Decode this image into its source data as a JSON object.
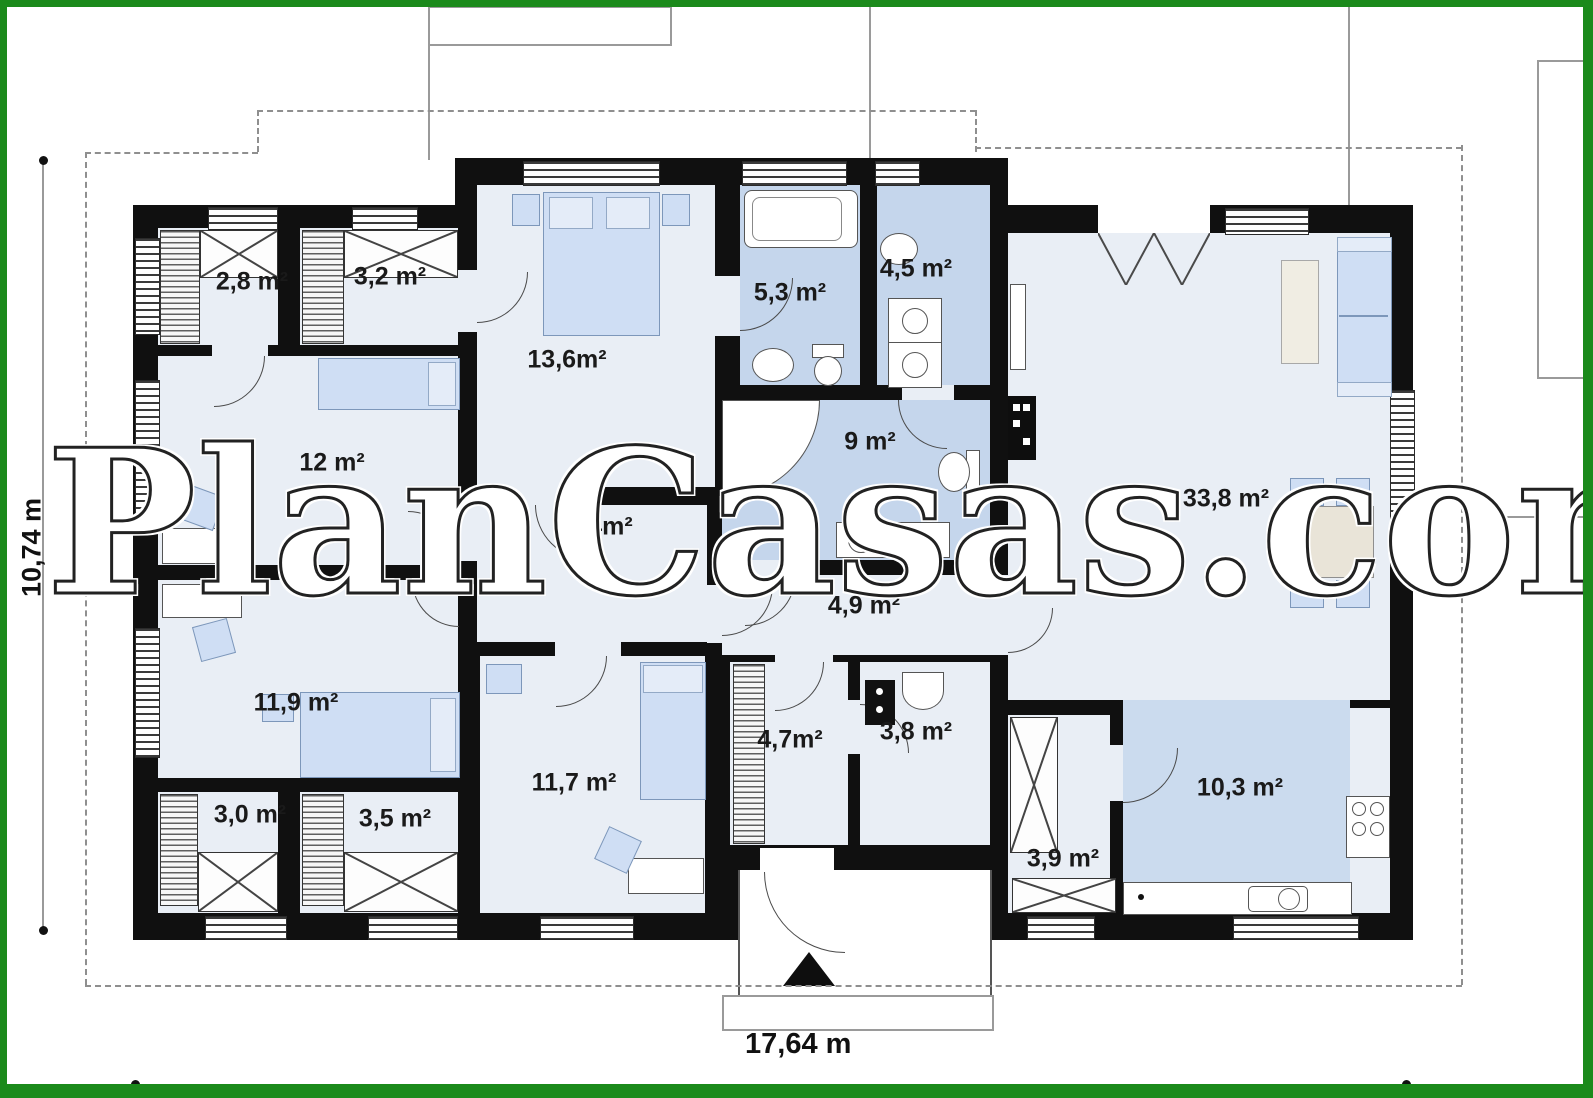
{
  "watermark": "PlanCasas.com",
  "dimensions": {
    "height_label": "10,74 m",
    "width_label": "17,64 m"
  },
  "colors": {
    "frame_green": "#1b8a1b",
    "wall": "#101010",
    "floor": "#e9eef5",
    "wet_room_blue": "#c5d6ec",
    "kitchen_floor_blue": "#cbdbee",
    "furniture_blue": "#cfdef4"
  },
  "rooms": [
    {
      "name": "wardrobe-small-left",
      "area": "2,8 m²"
    },
    {
      "name": "wardrobe-left",
      "area": "3,2 m²"
    },
    {
      "name": "bedroom-top",
      "area": "13,6m²"
    },
    {
      "name": "bathroom-main",
      "area": "5,3 m²"
    },
    {
      "name": "utility-room",
      "area": "4,5 m²"
    },
    {
      "name": "study",
      "area": "12 m²"
    },
    {
      "name": "hall-upper",
      "area": "7,4m²"
    },
    {
      "name": "bathroom-shower",
      "area": "9 m²"
    },
    {
      "name": "living-room",
      "area": "33,8 m²"
    },
    {
      "name": "hall-lower",
      "area": "4,9 m²"
    },
    {
      "name": "bedroom-left",
      "area": "11,9 m²"
    },
    {
      "name": "entry-hall",
      "area": "4,7m²"
    },
    {
      "name": "wc",
      "area": "3,8 m²"
    },
    {
      "name": "bedroom-bottom",
      "area": "11,7 m²"
    },
    {
      "name": "closet-bottom-small",
      "area": "3,0 m²"
    },
    {
      "name": "closet-bottom",
      "area": "3,5 m²"
    },
    {
      "name": "pantry",
      "area": "3,9 m²"
    },
    {
      "name": "kitchen",
      "area": "10,3 m²"
    }
  ]
}
